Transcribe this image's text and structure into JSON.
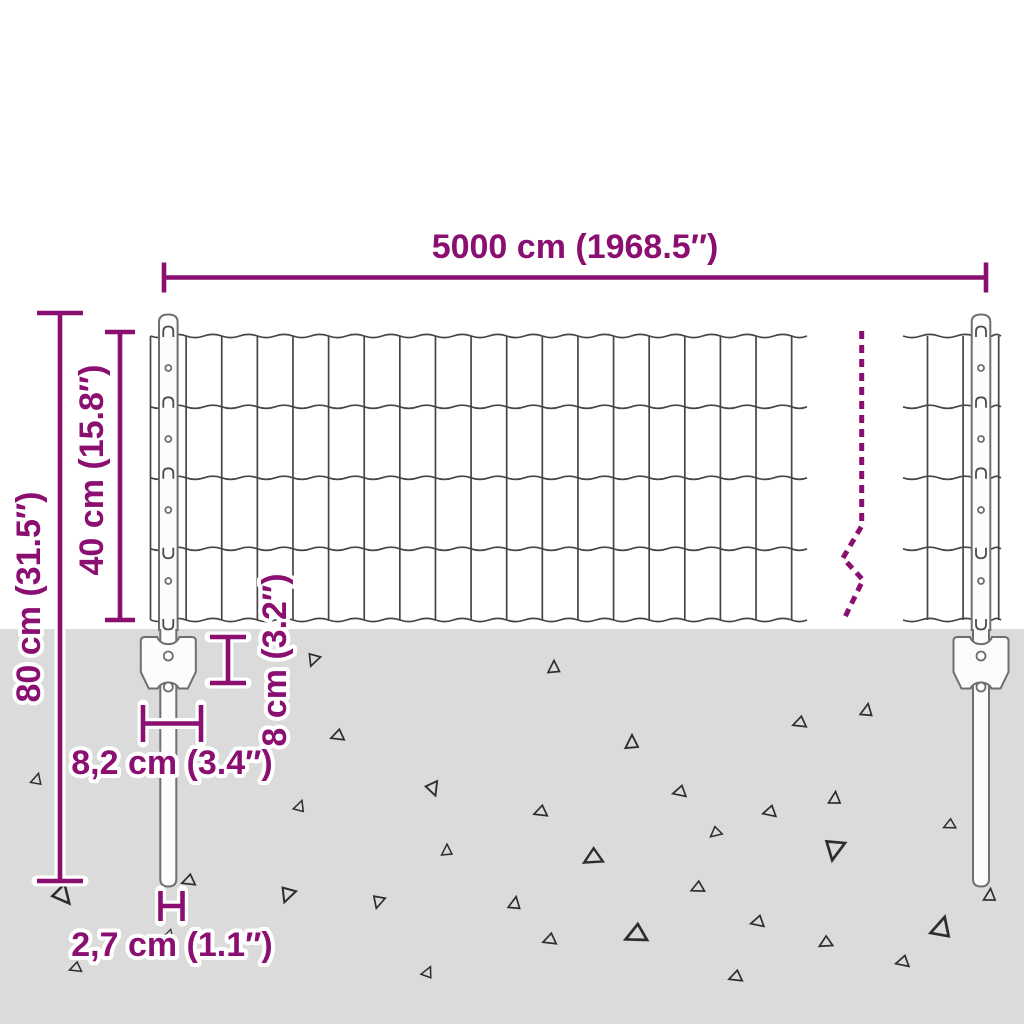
{
  "page": {
    "title": "Fence panel with posts — dimension diagram"
  },
  "dimensions": {
    "width": "5000 cm (1968.5″)",
    "total_height": "80 cm (31.5″)",
    "mesh_height": "40 cm (15.8″)",
    "anchor_height": "8 cm (3.2″)",
    "anchor_width": "8,2 cm (3.4″)",
    "post_diameter": "2,7 cm (1.1″)"
  },
  "colors": {
    "dimension": "#8a0f70",
    "background": "#ffffff",
    "ground": "#dbdbdb",
    "wire": "#454545",
    "outline": "#6f6f6f",
    "post_fill": "#fcfcfc"
  },
  "decor": {
    "gravel": [
      [
        37,
        779,
        0.9,
        15
      ],
      [
        313,
        660,
        1,
        200
      ],
      [
        337,
        736,
        1,
        250
      ],
      [
        433,
        789,
        1.1,
        160
      ],
      [
        300,
        806,
        0.9,
        20
      ],
      [
        63,
        896,
        1.5,
        140
      ],
      [
        188,
        881,
        1,
        250
      ],
      [
        287,
        895,
        1.2,
        200
      ],
      [
        378,
        902,
        1,
        195
      ],
      [
        447,
        850,
        0.9,
        0
      ],
      [
        75,
        968,
        0.9,
        250
      ],
      [
        428,
        972,
        0.9,
        25
      ],
      [
        170,
        935,
        0.7,
        140
      ],
      [
        554,
        667,
        1,
        0
      ],
      [
        632,
        742,
        1.1,
        0
      ],
      [
        799,
        723,
        1,
        250
      ],
      [
        867,
        710,
        1,
        10
      ],
      [
        679,
        792,
        1,
        255
      ],
      [
        540,
        812,
        1,
        250
      ],
      [
        769,
        812,
        1,
        255
      ],
      [
        835,
        798,
        1,
        5
      ],
      [
        715,
        833,
        0.9,
        230
      ],
      [
        949,
        825,
        0.9,
        245
      ],
      [
        834,
        850,
        1.6,
        190
      ],
      [
        592,
        858,
        1.4,
        240
      ],
      [
        697,
        888,
        1,
        245
      ],
      [
        515,
        903,
        1,
        10
      ],
      [
        757,
        922,
        1,
        255
      ],
      [
        635,
        935,
        1.6,
        245
      ],
      [
        549,
        940,
        1,
        250
      ],
      [
        825,
        943,
        1,
        240
      ],
      [
        942,
        927,
        1.6,
        15
      ],
      [
        990,
        895,
        1,
        5
      ],
      [
        902,
        962,
        1,
        255
      ],
      [
        735,
        977,
        1,
        250
      ]
    ]
  }
}
